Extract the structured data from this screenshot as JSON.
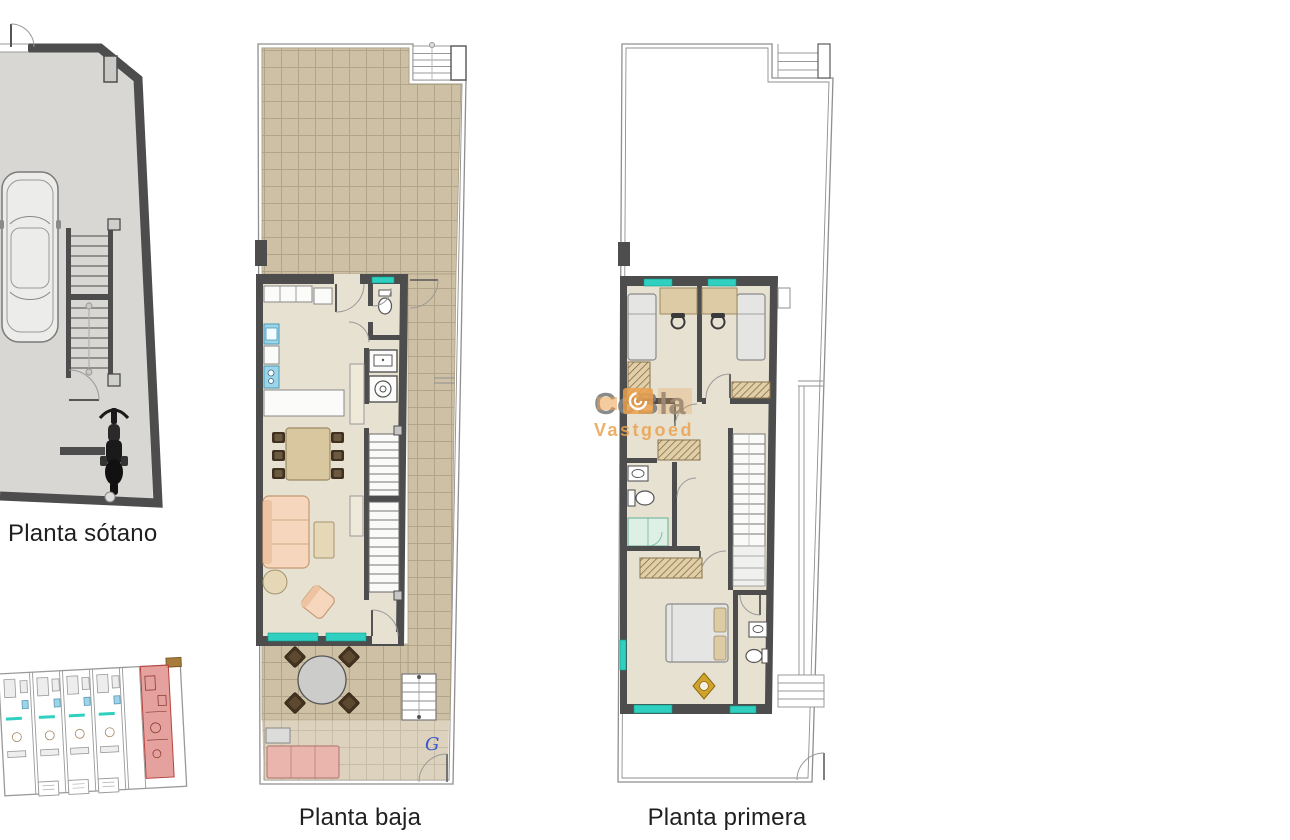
{
  "sheet": {
    "background": "#ffffff"
  },
  "plans": {
    "basement": {
      "label": "Planta sótano"
    },
    "ground": {
      "label": "Planta baja",
      "garage_letter": "G"
    },
    "first": {
      "label": "Planta primera"
    }
  },
  "watermark": {
    "brand": "CoBla",
    "subtitle": "Vastgoed"
  },
  "colors": {
    "wall": "#4d4d4d",
    "basement_floor": "#d8d7d4",
    "terrace_tile": "#cec0a4",
    "tile_line": "#b1a488",
    "interior_floor": "#e7e1d2",
    "window_accent": "#2fd0bf",
    "appliance_blue": "#9cd4e8",
    "furniture_tan": "#d9c7a0",
    "sofa_peach": "#f6d7bd",
    "lounger_pink": "#eab5ac",
    "site_highlight": "#e29792",
    "watermark_orange": "#eaa14e",
    "watermark_gray": "#8b8b8b",
    "garage_letter_blue": "#3a55c8",
    "label_text": "#1f1f1f"
  }
}
